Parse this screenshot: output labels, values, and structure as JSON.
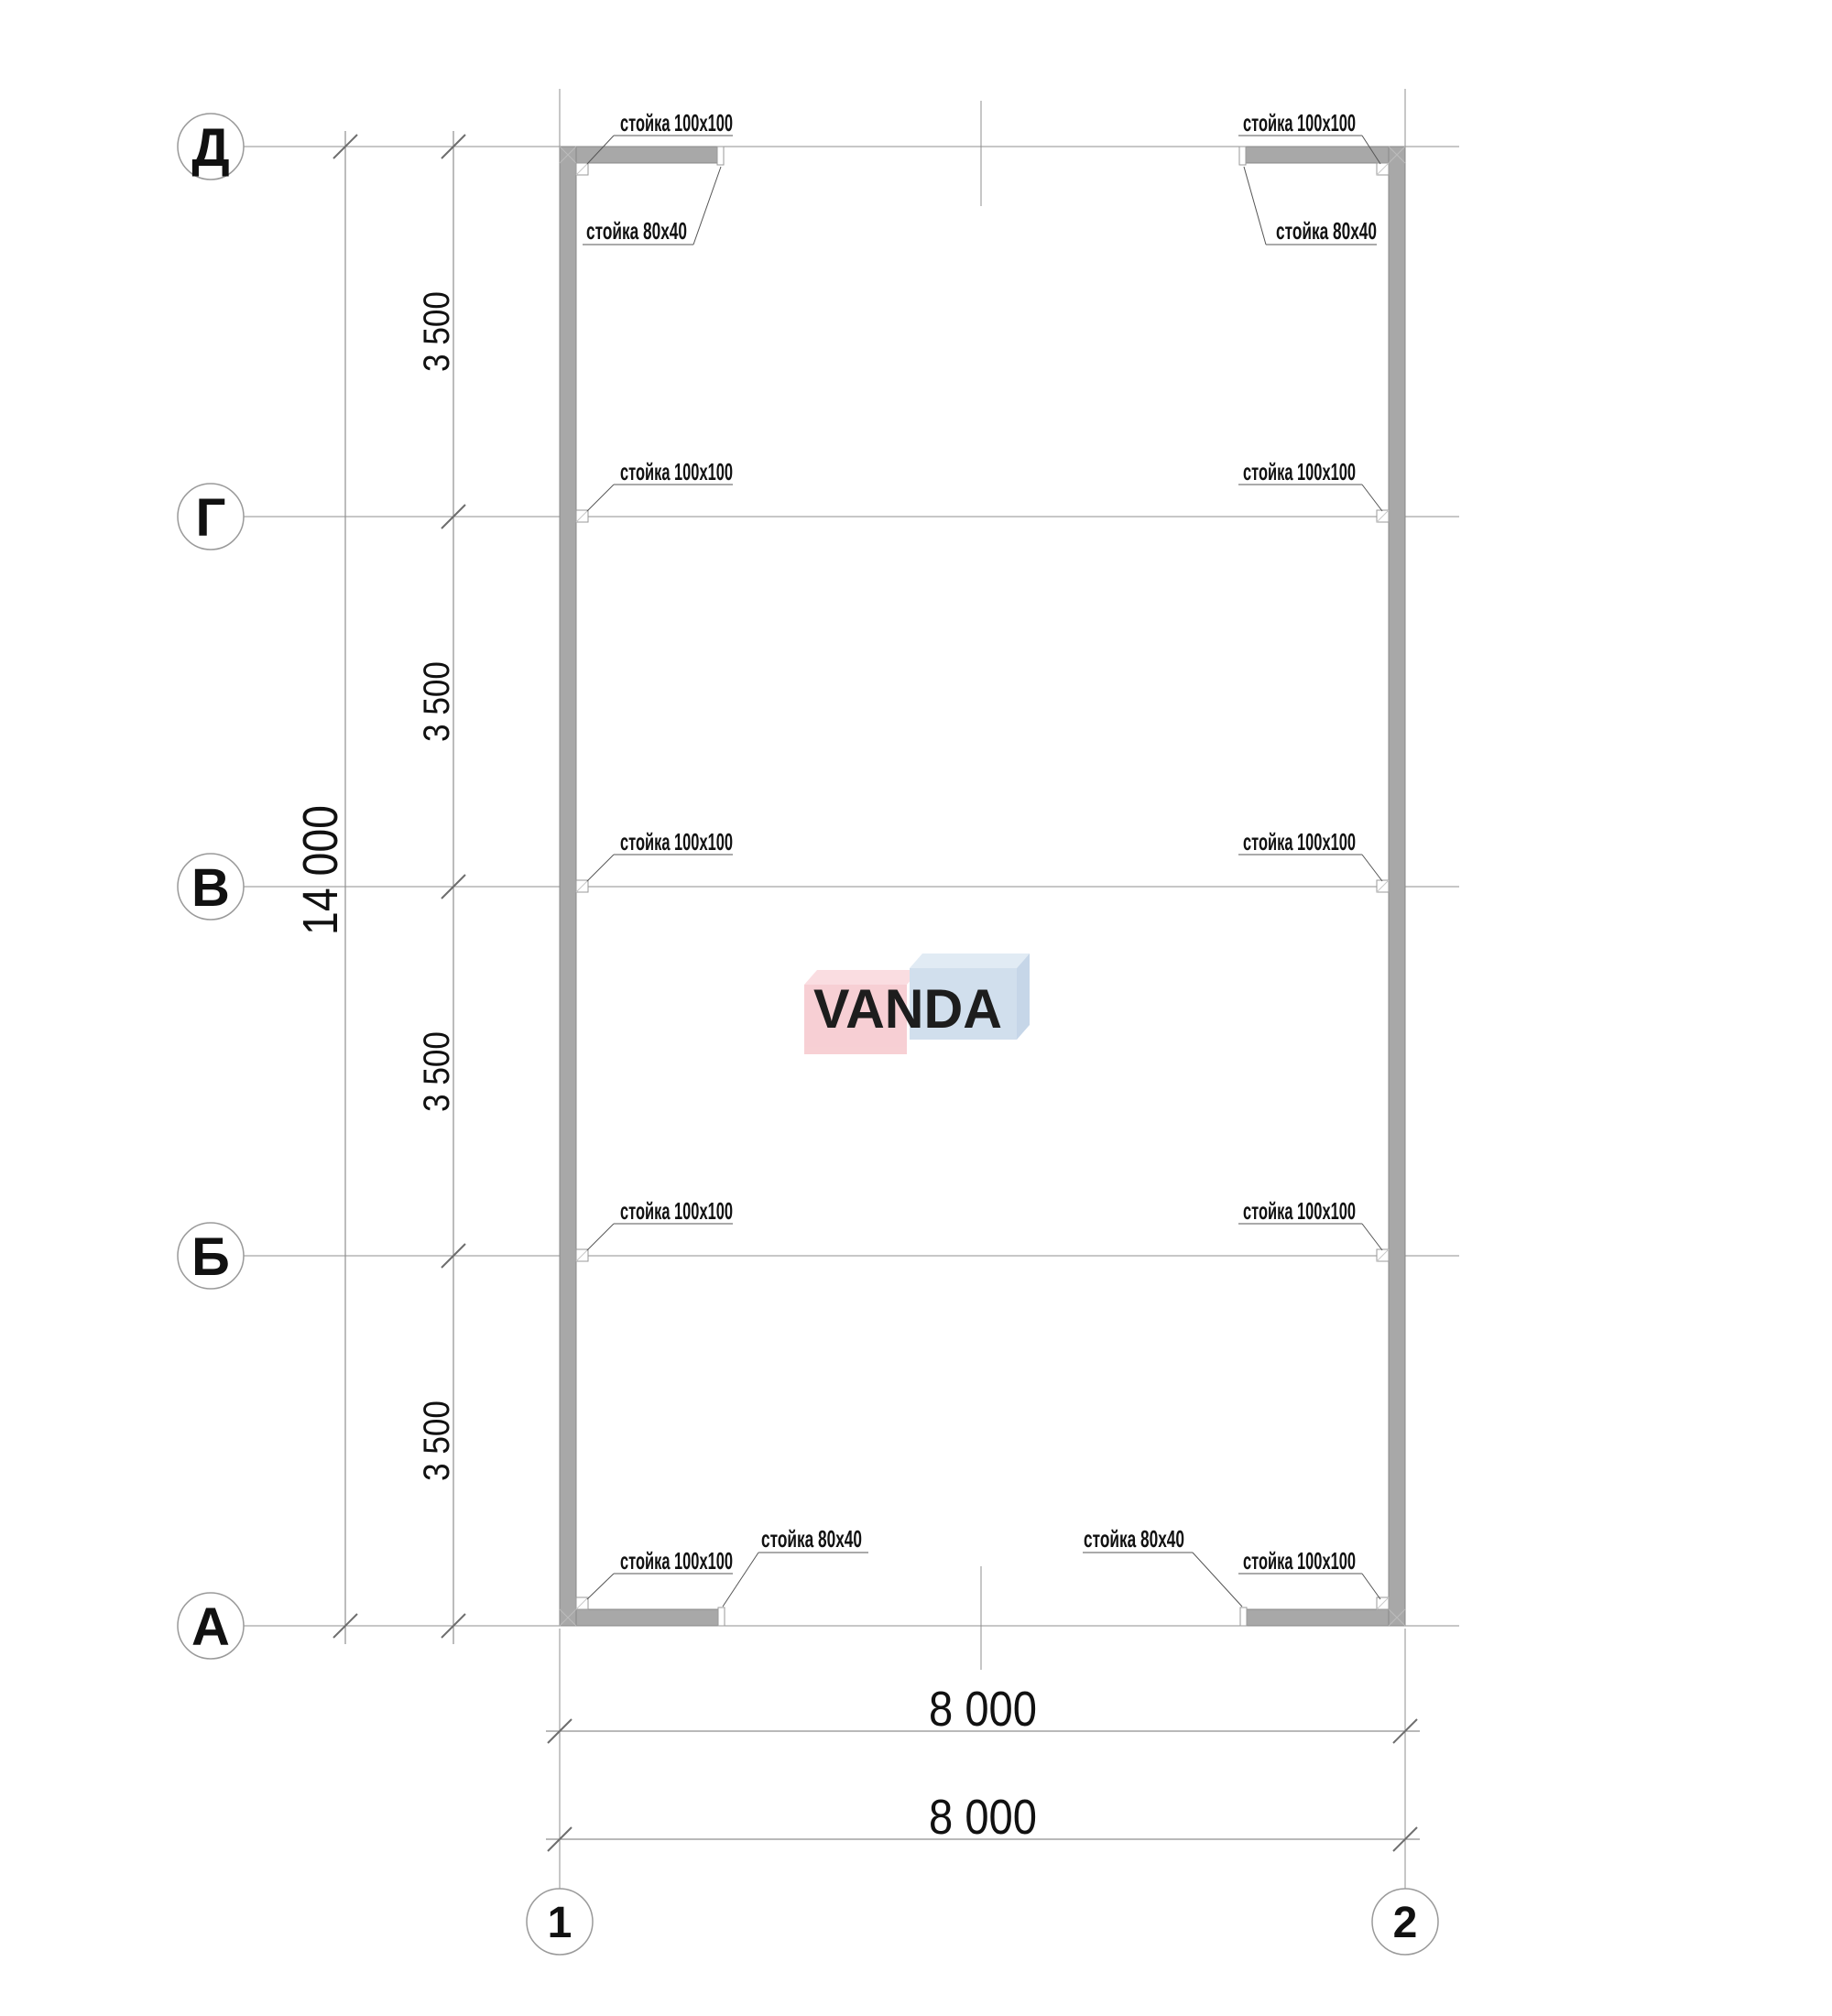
{
  "axes": {
    "rows": [
      {
        "label": "Д"
      },
      {
        "label": "Г"
      },
      {
        "label": "В"
      },
      {
        "label": "Б"
      },
      {
        "label": "А"
      }
    ],
    "cols": [
      {
        "label": "1"
      },
      {
        "label": "2"
      }
    ]
  },
  "dimensions": {
    "left_total": "14 000",
    "left_segments": [
      "3 500",
      "3 500",
      "3 500",
      "3 500"
    ],
    "bottom_lines": [
      "8 000",
      "8 000"
    ]
  },
  "annotations": {
    "post_corner": "стойка 100х100",
    "post_side": "стойка 80х40"
  },
  "watermark": {
    "text": "VANDA",
    "pink": "#f7cdd2",
    "pink_top": "#fadce0",
    "pink_border": "#f0b6bd",
    "blue": "#cfdeed",
    "blue_top": "#e0eaf4",
    "blue_side": "#c3d4e7",
    "blue_border": "#b8cde2",
    "text_color": "#ffffff"
  }
}
